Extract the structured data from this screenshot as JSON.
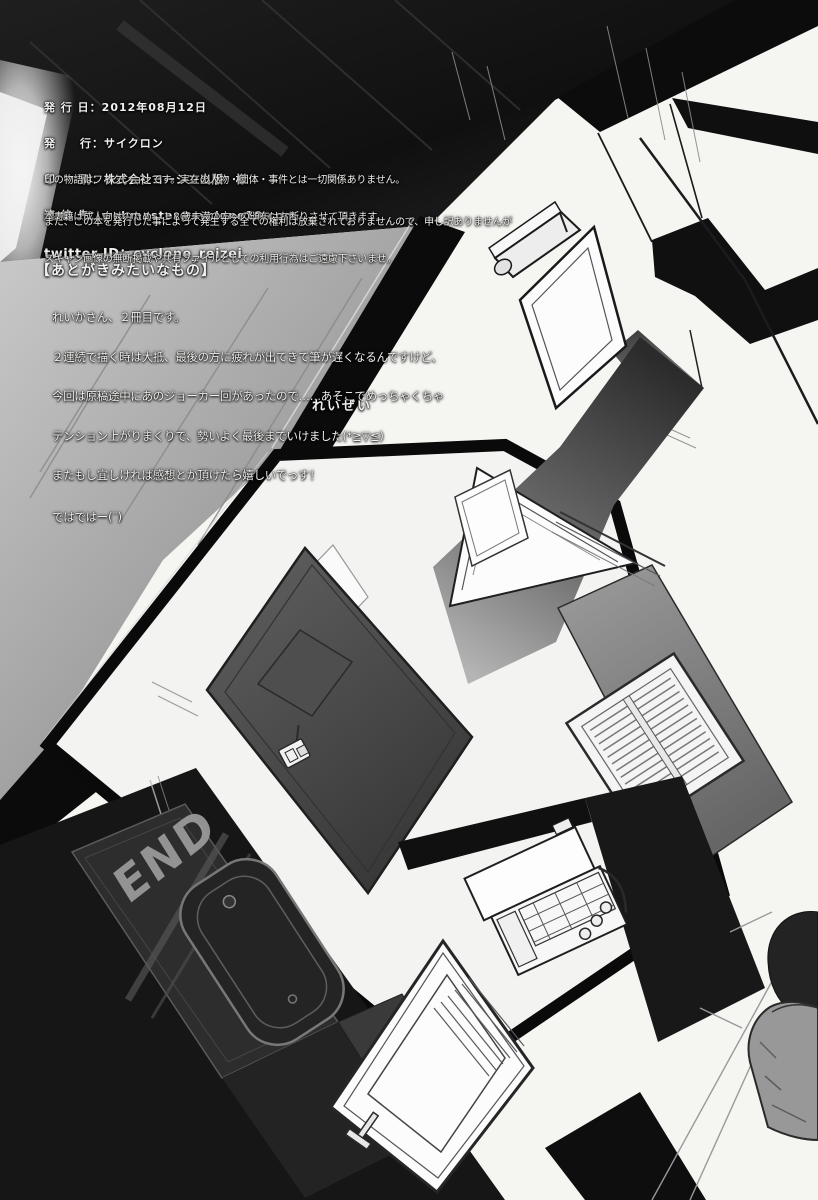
{
  "credits": {
    "lines": [
      "発 行 日：2012年08月12日",
      "発　　行：サイクロン",
      "印　　刷：株式会社ヨーシン出版　様",
      "連 絡 先：webmaster@cyclone10.com",
      "twitter ID：cyclone_reizei"
    ]
  },
  "disclaimer": {
    "lines": [
      "この物語はフィクションです。実在の人物・団体・事件とは一切関係ありません。",
      "本書籍は成人向けのため、１８歳未満の方への頒布はお断りさせて頂きます。"
    ]
  },
  "rights": {
    "lines": [
      "また、この本を発行した事によって発生する全ての権利は放棄されておりませんので、申し訳ありませんが",
      "スキャン画像の無断掲載や共有ファイルとしての利用行為はご遠慮下さいませ。"
    ]
  },
  "afterword": {
    "heading": "【あとがきみたいなもの】",
    "lines": [
      "れいかさん、２冊目です。",
      "２連続で描く時は大抵、最後の方に疲れが出てきて筆が遅くなるんですけど、",
      "今回は原稿途中にあのジョーカー回があったので……あそこでめっちゃくちゃ",
      "テンション上がりまくりで、勢いよく最後までいけました(*≧▽≦)",
      "またもし宜しければ感想とか頂けたら嬉しいでっす！",
      "ではではー(¨)"
    ],
    "signature": "れいぜい"
  },
  "artwork": {
    "end_graffiti": "END"
  },
  "colors": {
    "ink_black": "#101010",
    "page_white": "#f5f5f2",
    "floor_gray": "#9a9a9a",
    "graffiti_gray": "#9c9c9c"
  }
}
